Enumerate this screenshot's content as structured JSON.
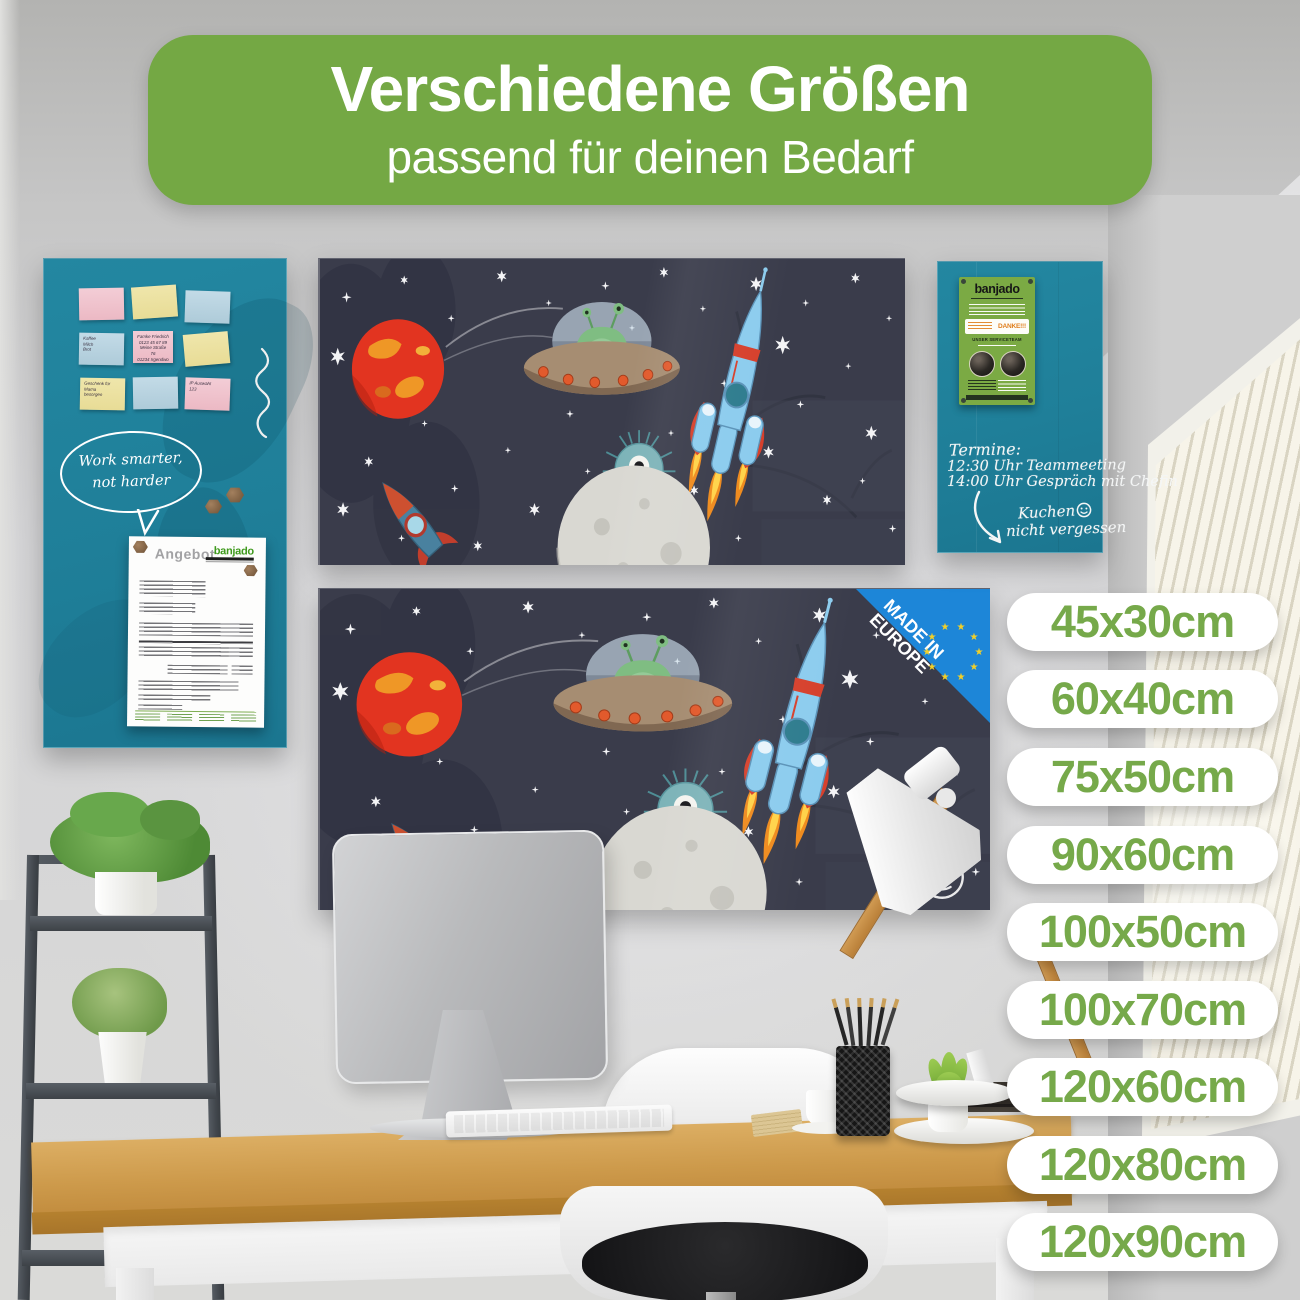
{
  "banner": {
    "title": "Verschiedene Größen",
    "subtitle": "passend für deinen Bedarf"
  },
  "size_pills": [
    "45x30cm",
    "60x40cm",
    "75x50cm",
    "90x60cm",
    "100x50cm",
    "100x70cm",
    "120x60cm",
    "120x80cm",
    "120x90cm"
  ],
  "badge": {
    "line1": "MADE IN",
    "line2": "EUROPE"
  },
  "left_board": {
    "speech_bubble_line1": "Work smarter,",
    "speech_bubble_line2": "not harder",
    "notes": {
      "shopping": "Kaffee\nMilch\nBrot",
      "contact": "Famke Friedrich\n0123 45 67 89\nMeine Straße 76\n01234 Irgendwo",
      "gift": "Geschenk für\nMama\nbesorgen",
      "misc": "IP Auswahl\n123"
    },
    "document": {
      "title": "Angebot",
      "brand": "banjado"
    }
  },
  "right_board": {
    "flyer": {
      "brand": "banjado",
      "danke": "DANKE!!!",
      "service": "UNSER SERVICETEAM"
    },
    "line1": "Termine:",
    "line2": "12:30 Uhr Teammeeting",
    "line3": "14:00 Uhr Gespräch mit Chefin",
    "reminder1": "Kuchen",
    "reminder2": "nicht vergessen"
  },
  "colors": {
    "banner_green": "#74a844",
    "pill_text_green": "#76a94a",
    "teal_board": "#1f7f99",
    "space_navy": "#3a3c4b",
    "badge_blue": "#1d86d8",
    "eu_star_yellow": "#f2d028"
  }
}
